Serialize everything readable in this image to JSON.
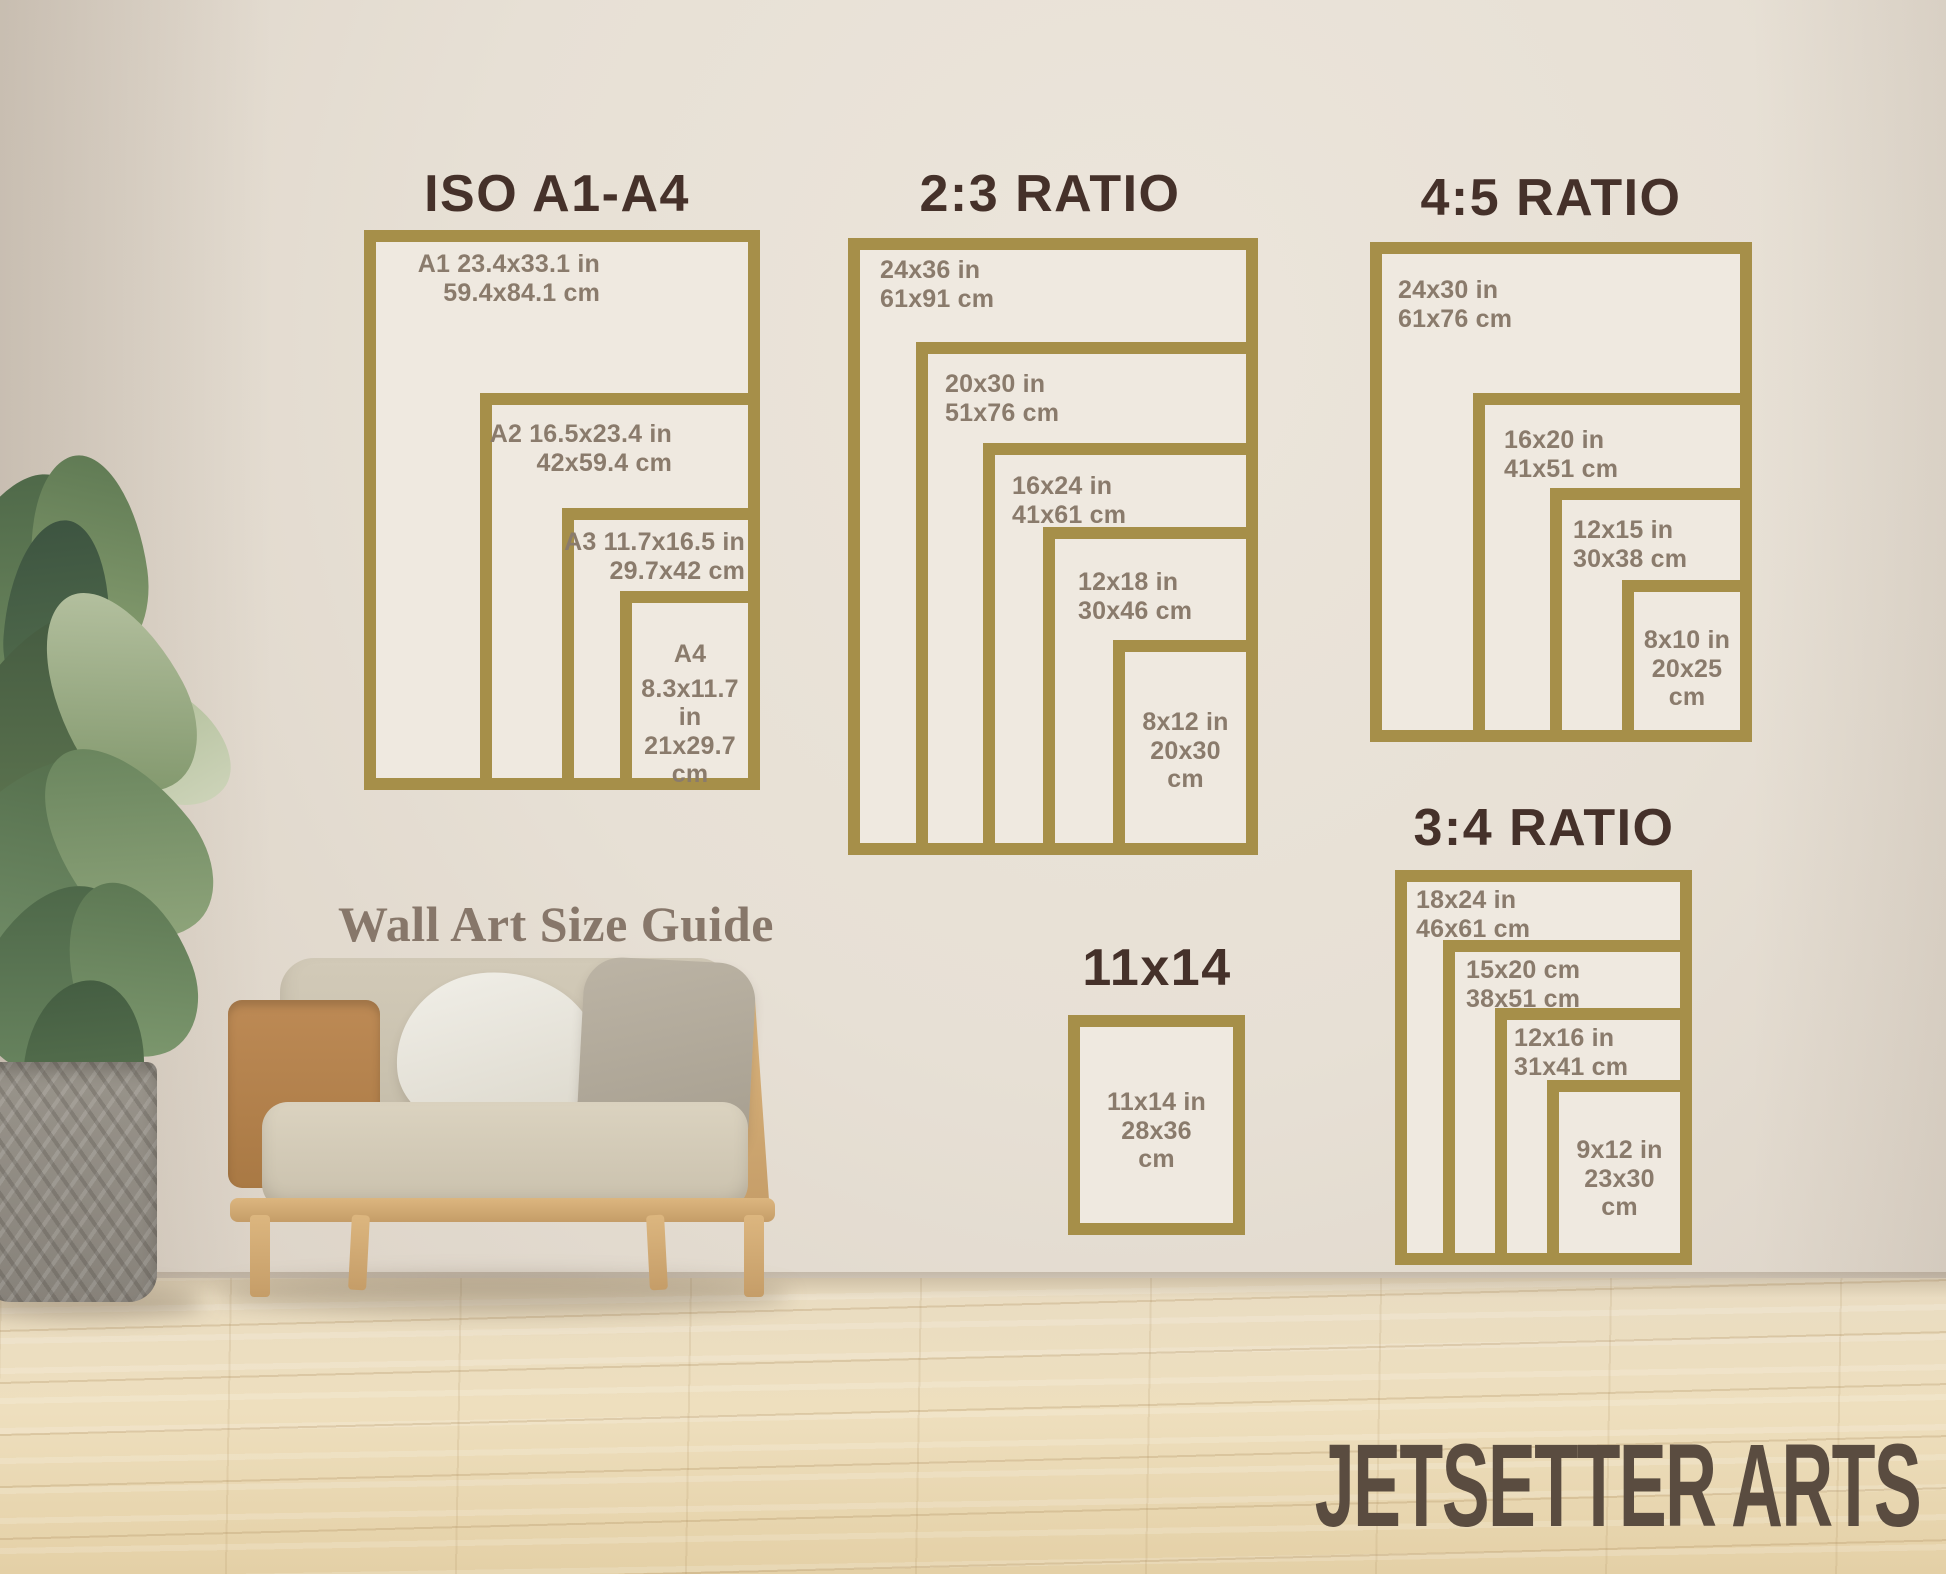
{
  "caption": "Wall Art Size Guide",
  "watermark": "JETSETTER ARTS",
  "colors": {
    "frame_gold": "#a68f49",
    "title_brown": "#45312a",
    "label_brown": "#8a7b6c",
    "wall": "#e7e0d5",
    "floor_wood": "#ecdcba",
    "watermark_brown": "#5a4c40"
  },
  "sections": [
    {
      "id": "iso-a1-a4",
      "title": "ISO A1-A4",
      "frames": [
        {
          "name": "A1",
          "lines": [
            "A1 23.4x33.1 in",
            "59.4x84.1 cm"
          ]
        },
        {
          "name": "A2",
          "lines": [
            "A2 16.5x23.4 in",
            "42x59.4 cm"
          ]
        },
        {
          "name": "A3",
          "lines": [
            "A3 11.7x16.5 in",
            "29.7x42 cm"
          ]
        },
        {
          "name": "A4",
          "lines": [
            "A4",
            "8.3x11.7 in",
            "21x29.7",
            "cm"
          ]
        }
      ]
    },
    {
      "id": "ratio-2-3",
      "title": "2:3 RATIO",
      "frames": [
        {
          "name": "24x36",
          "lines": [
            "24x36 in",
            "61x91 cm"
          ]
        },
        {
          "name": "20x30",
          "lines": [
            "20x30 in",
            "51x76 cm"
          ]
        },
        {
          "name": "16x24",
          "lines": [
            "16x24 in",
            "41x61 cm"
          ]
        },
        {
          "name": "12x18",
          "lines": [
            "12x18 in",
            "30x46 cm"
          ]
        },
        {
          "name": "8x12",
          "lines": [
            "8x12 in",
            "20x30",
            "cm"
          ]
        }
      ]
    },
    {
      "id": "ratio-4-5",
      "title": "4:5 RATIO",
      "frames": [
        {
          "name": "24x30",
          "lines": [
            "24x30 in",
            "61x76 cm"
          ]
        },
        {
          "name": "16x20",
          "lines": [
            "16x20 in",
            "41x51 cm"
          ]
        },
        {
          "name": "12x15",
          "lines": [
            "12x15 in",
            "30x38 cm"
          ]
        },
        {
          "name": "8x10",
          "lines": [
            "8x10 in",
            "20x25",
            "cm"
          ]
        }
      ]
    },
    {
      "id": "ratio-3-4",
      "title": "3:4 RATIO",
      "frames": [
        {
          "name": "18x24",
          "lines": [
            "18x24 in",
            "46x61 cm"
          ]
        },
        {
          "name": "15x20",
          "lines": [
            "15x20 cm",
            "38x51 cm"
          ]
        },
        {
          "name": "12x16",
          "lines": [
            "12x16 in",
            "31x41 cm"
          ]
        },
        {
          "name": "9x12",
          "lines": [
            "9x12 in",
            "23x30",
            "cm"
          ]
        }
      ]
    },
    {
      "id": "size-11x14",
      "title": "11x14",
      "frames": [
        {
          "name": "11x14",
          "lines": [
            "11x14 in",
            "28x36",
            "cm"
          ]
        }
      ]
    }
  ]
}
